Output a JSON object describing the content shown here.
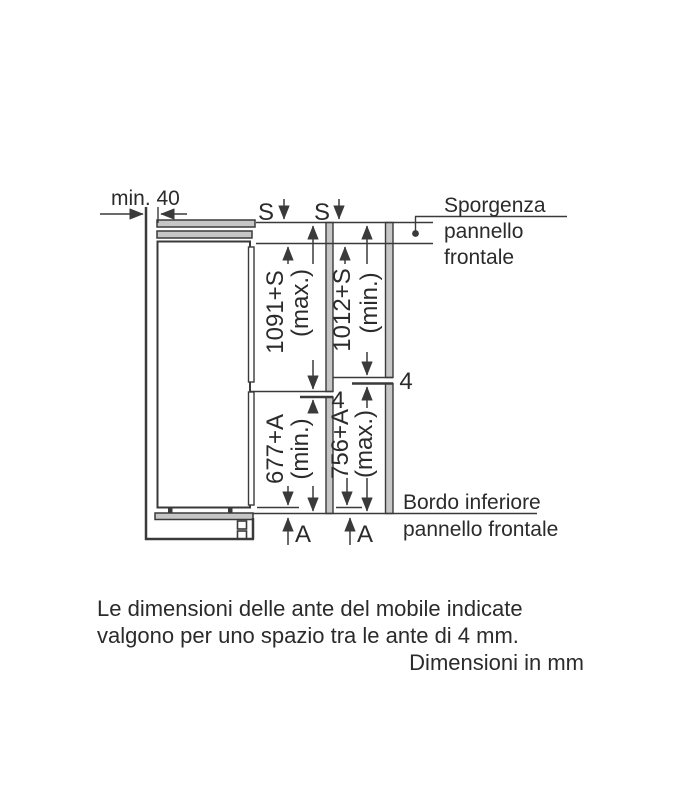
{
  "figure": {
    "title": "Schema di installazione frigorifero da incasso"
  },
  "labels": {
    "min_clearance": "min. 40",
    "s_overhang": "S",
    "a_overhang": "A",
    "panel_gap": "4"
  },
  "dimensions": {
    "upper_left": {
      "value": "1091+S",
      "qualifier": "(max.)"
    },
    "upper_right": {
      "value": "1012+S",
      "qualifier": "(min.)"
    },
    "lower_left": {
      "value": "677+A",
      "qualifier": "(min.)"
    },
    "lower_right": {
      "value": "756+A",
      "qualifier": "(max.)"
    }
  },
  "callouts": {
    "sporgenza": {
      "line1": "Sporgenza",
      "line2": "pannello",
      "line3": "frontale"
    },
    "bordo": {
      "line1": "Bordo inferiore",
      "line2": "pannello frontale"
    }
  },
  "note": {
    "line1": "Le dimensioni delle ante del mobile indicate",
    "line2": "valgono per uno spazio tra le ante di 4 mm.",
    "line3": "Dimensioni in mm"
  },
  "colors": {
    "line": "#3a3a3a",
    "panel_fill": "#c6c6c6",
    "background": "#ffffff"
  }
}
